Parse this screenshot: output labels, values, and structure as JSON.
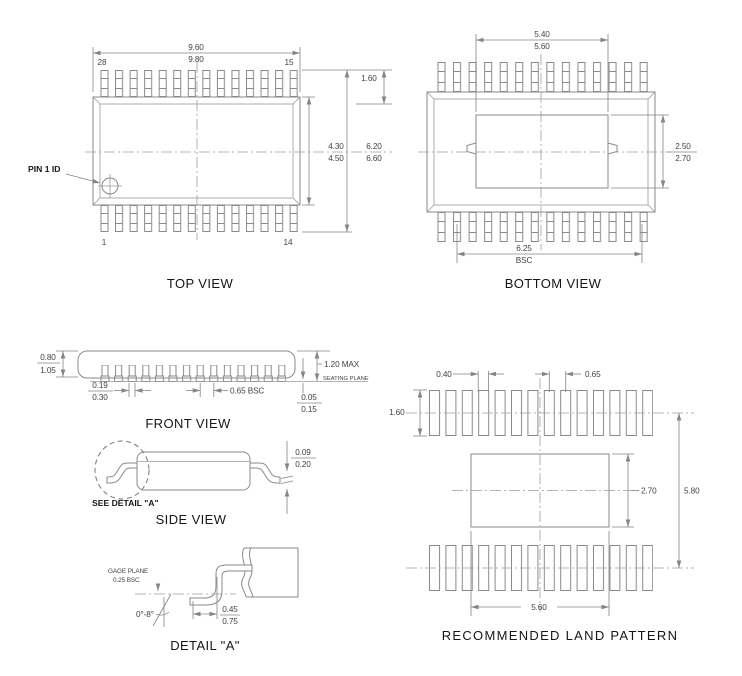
{
  "colors": {
    "line": "#8a8a8a",
    "centerline": "#9e9e9e",
    "dim_text": "#41424a",
    "label_text": "#15151a",
    "background": "#ffffff"
  },
  "top_view": {
    "caption": "TOP VIEW",
    "pin1_label": "PIN 1 ID",
    "pin_top_left": "28",
    "pin_top_right": "15",
    "pin_bottom_left": "1",
    "pin_bottom_right": "14",
    "dim_width_min": "9.60",
    "dim_width_max": "9.80",
    "dim_lead": "1.60",
    "dim_body_h_min": "4.30",
    "dim_body_h_max": "4.50",
    "dim_overall_h_min": "6.20",
    "dim_overall_h_max": "6.60"
  },
  "bottom_view": {
    "caption": "BOTTOM VIEW",
    "dim_pad_w_min": "5.40",
    "dim_pad_w_max": "5.60",
    "dim_pad_h_min": "2.50",
    "dim_pad_h_max": "2.70",
    "dim_span": "6.25",
    "dim_span_note": "BSC"
  },
  "front_view": {
    "caption": "FRONT VIEW",
    "dim_body_t_min": "0.80",
    "dim_body_t_max": "1.05",
    "dim_height": "1.20  MAX",
    "seating_plane": "SEATING PLANE",
    "dim_lead_w_min": "0.19",
    "dim_lead_w_max": "0.30",
    "dim_pitch": "0.65  BSC",
    "dim_standoff_min": "0.05",
    "dim_standoff_max": "0.15"
  },
  "side_view": {
    "caption": "SIDE VIEW",
    "see_detail": "SEE DETAIL \"A\"",
    "dim_lead_t_min": "0.09",
    "dim_lead_t_max": "0.20"
  },
  "detail_a": {
    "caption": "DETAIL \"A\"",
    "gage_plane_line1": "GAGE PLANE",
    "gage_plane_line2": "0.25 BSC",
    "angle": "0°-8°",
    "dim_foot_min": "0.45",
    "dim_foot_max": "0.75"
  },
  "land_pattern": {
    "caption": "RECOMMENDED LAND PATTERN",
    "dim_pad_w": "0.40",
    "dim_pitch": "0.65",
    "dim_pad_l": "1.60",
    "dim_center_h": "2.70",
    "dim_row_span": "5.80",
    "dim_center_w": "5.60"
  }
}
